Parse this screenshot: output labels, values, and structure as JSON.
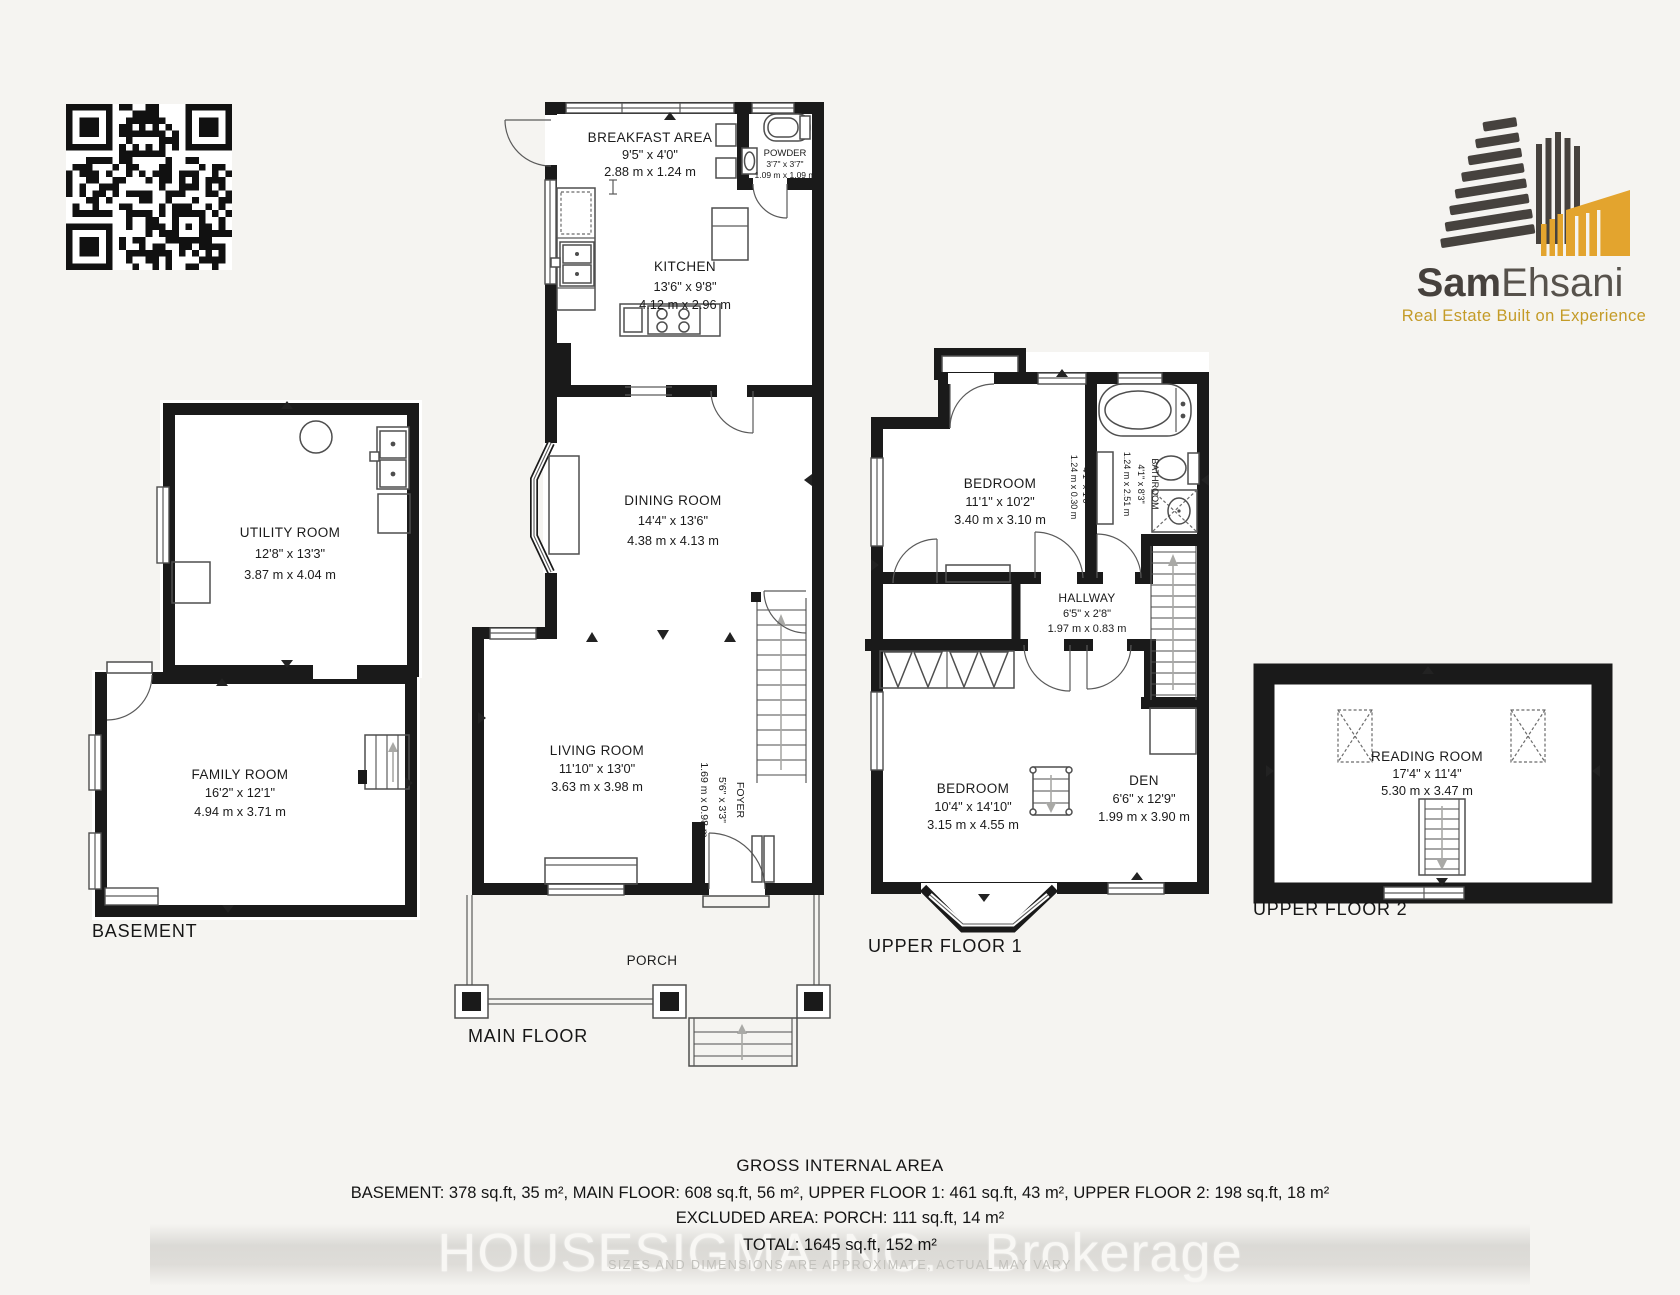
{
  "logo": {
    "brand_bold": "Sam",
    "brand_light": "Ehsani",
    "tagline": "Real Estate Built on Experience"
  },
  "floor_labels": {
    "basement": "BASEMENT",
    "main": "MAIN FLOOR",
    "upper1": "UPPER FLOOR 1",
    "upper2": "UPPER FLOOR 2"
  },
  "rooms": {
    "utility": {
      "name": "UTILITY ROOM",
      "feet": "12'8\" x 13'3\"",
      "meters": "3.87 m x 4.04 m"
    },
    "family": {
      "name": "FAMILY ROOM",
      "feet": "16'2\" x 12'1\"",
      "meters": "4.94 m x 3.71 m"
    },
    "breakfast": {
      "name": "BREAKFAST AREA",
      "feet": "9'5\" x 4'0\"",
      "meters": "2.88 m x 1.24 m"
    },
    "powder": {
      "name": "POWDER",
      "feet": "3'7\" x 3'7\"",
      "meters": "1.09 m x 1.09 m"
    },
    "kitchen": {
      "name": "KITCHEN",
      "feet": "13'6\" x 9'8\"",
      "meters": "4.12 m x 2.96 m"
    },
    "dining": {
      "name": "DINING ROOM",
      "feet": "14'4\" x 13'6\"",
      "meters": "4.38 m x 4.13 m"
    },
    "living": {
      "name": "LIVING ROOM",
      "feet": "11'10\" x 13'0\"",
      "meters": "3.63 m x 3.98 m"
    },
    "foyer": {
      "name": "FOYER",
      "feet": "5'6\" x 3'3\"",
      "meters": "1.69 m x 0.98 m"
    },
    "porch": {
      "name": "PORCH"
    },
    "bedroom2": {
      "name": "BEDROOM",
      "feet": "11'1\" x 10'2\"",
      "meters": "3.40 m x 3.10 m"
    },
    "bathroom": {
      "name": "BATHROOM",
      "feet": "4'1\" x 8'3\"",
      "meters": "1.24 m x 2.51 m"
    },
    "closet": {
      "feet": "4'1\" x 1'0\"",
      "meters": "1.24 m x 0.30 m"
    },
    "hallway": {
      "name": "HALLWAY",
      "feet": "6'5\" x 2'8\"",
      "meters": "1.97 m x 0.83 m"
    },
    "bedroom1": {
      "name": "BEDROOM",
      "feet": "10'4\" x 14'10\"",
      "meters": "3.15 m x 4.55 m"
    },
    "den": {
      "name": "DEN",
      "feet": "6'6\" x 12'9\"",
      "meters": "1.99 m x 3.90 m"
    },
    "reading": {
      "name": "READING ROOM",
      "feet": "17'4\" x 11'4\"",
      "meters": "5.30 m x 3.47 m"
    }
  },
  "footer": {
    "title": "GROSS INTERNAL AREA",
    "areas": "BASEMENT: 378 sq.ft, 35 m², MAIN FLOOR: 608 sq.ft, 56 m², UPPER FLOOR 1: 461 sq.ft, 43 m², UPPER FLOOR 2: 198 sq.ft, 18 m²",
    "excluded": "EXCLUDED AREA: PORCH: 111 sq.ft, 14 m²",
    "total": "TOTAL: 1645 sq.ft, 152 m²",
    "disclaimer": "SIZES AND DIMENSIONS ARE APPROXIMATE, ACTUAL MAY VARY"
  },
  "watermark": {
    "part1": "HOUSESIGMA INC.",
    "part2": "Brokerage"
  }
}
